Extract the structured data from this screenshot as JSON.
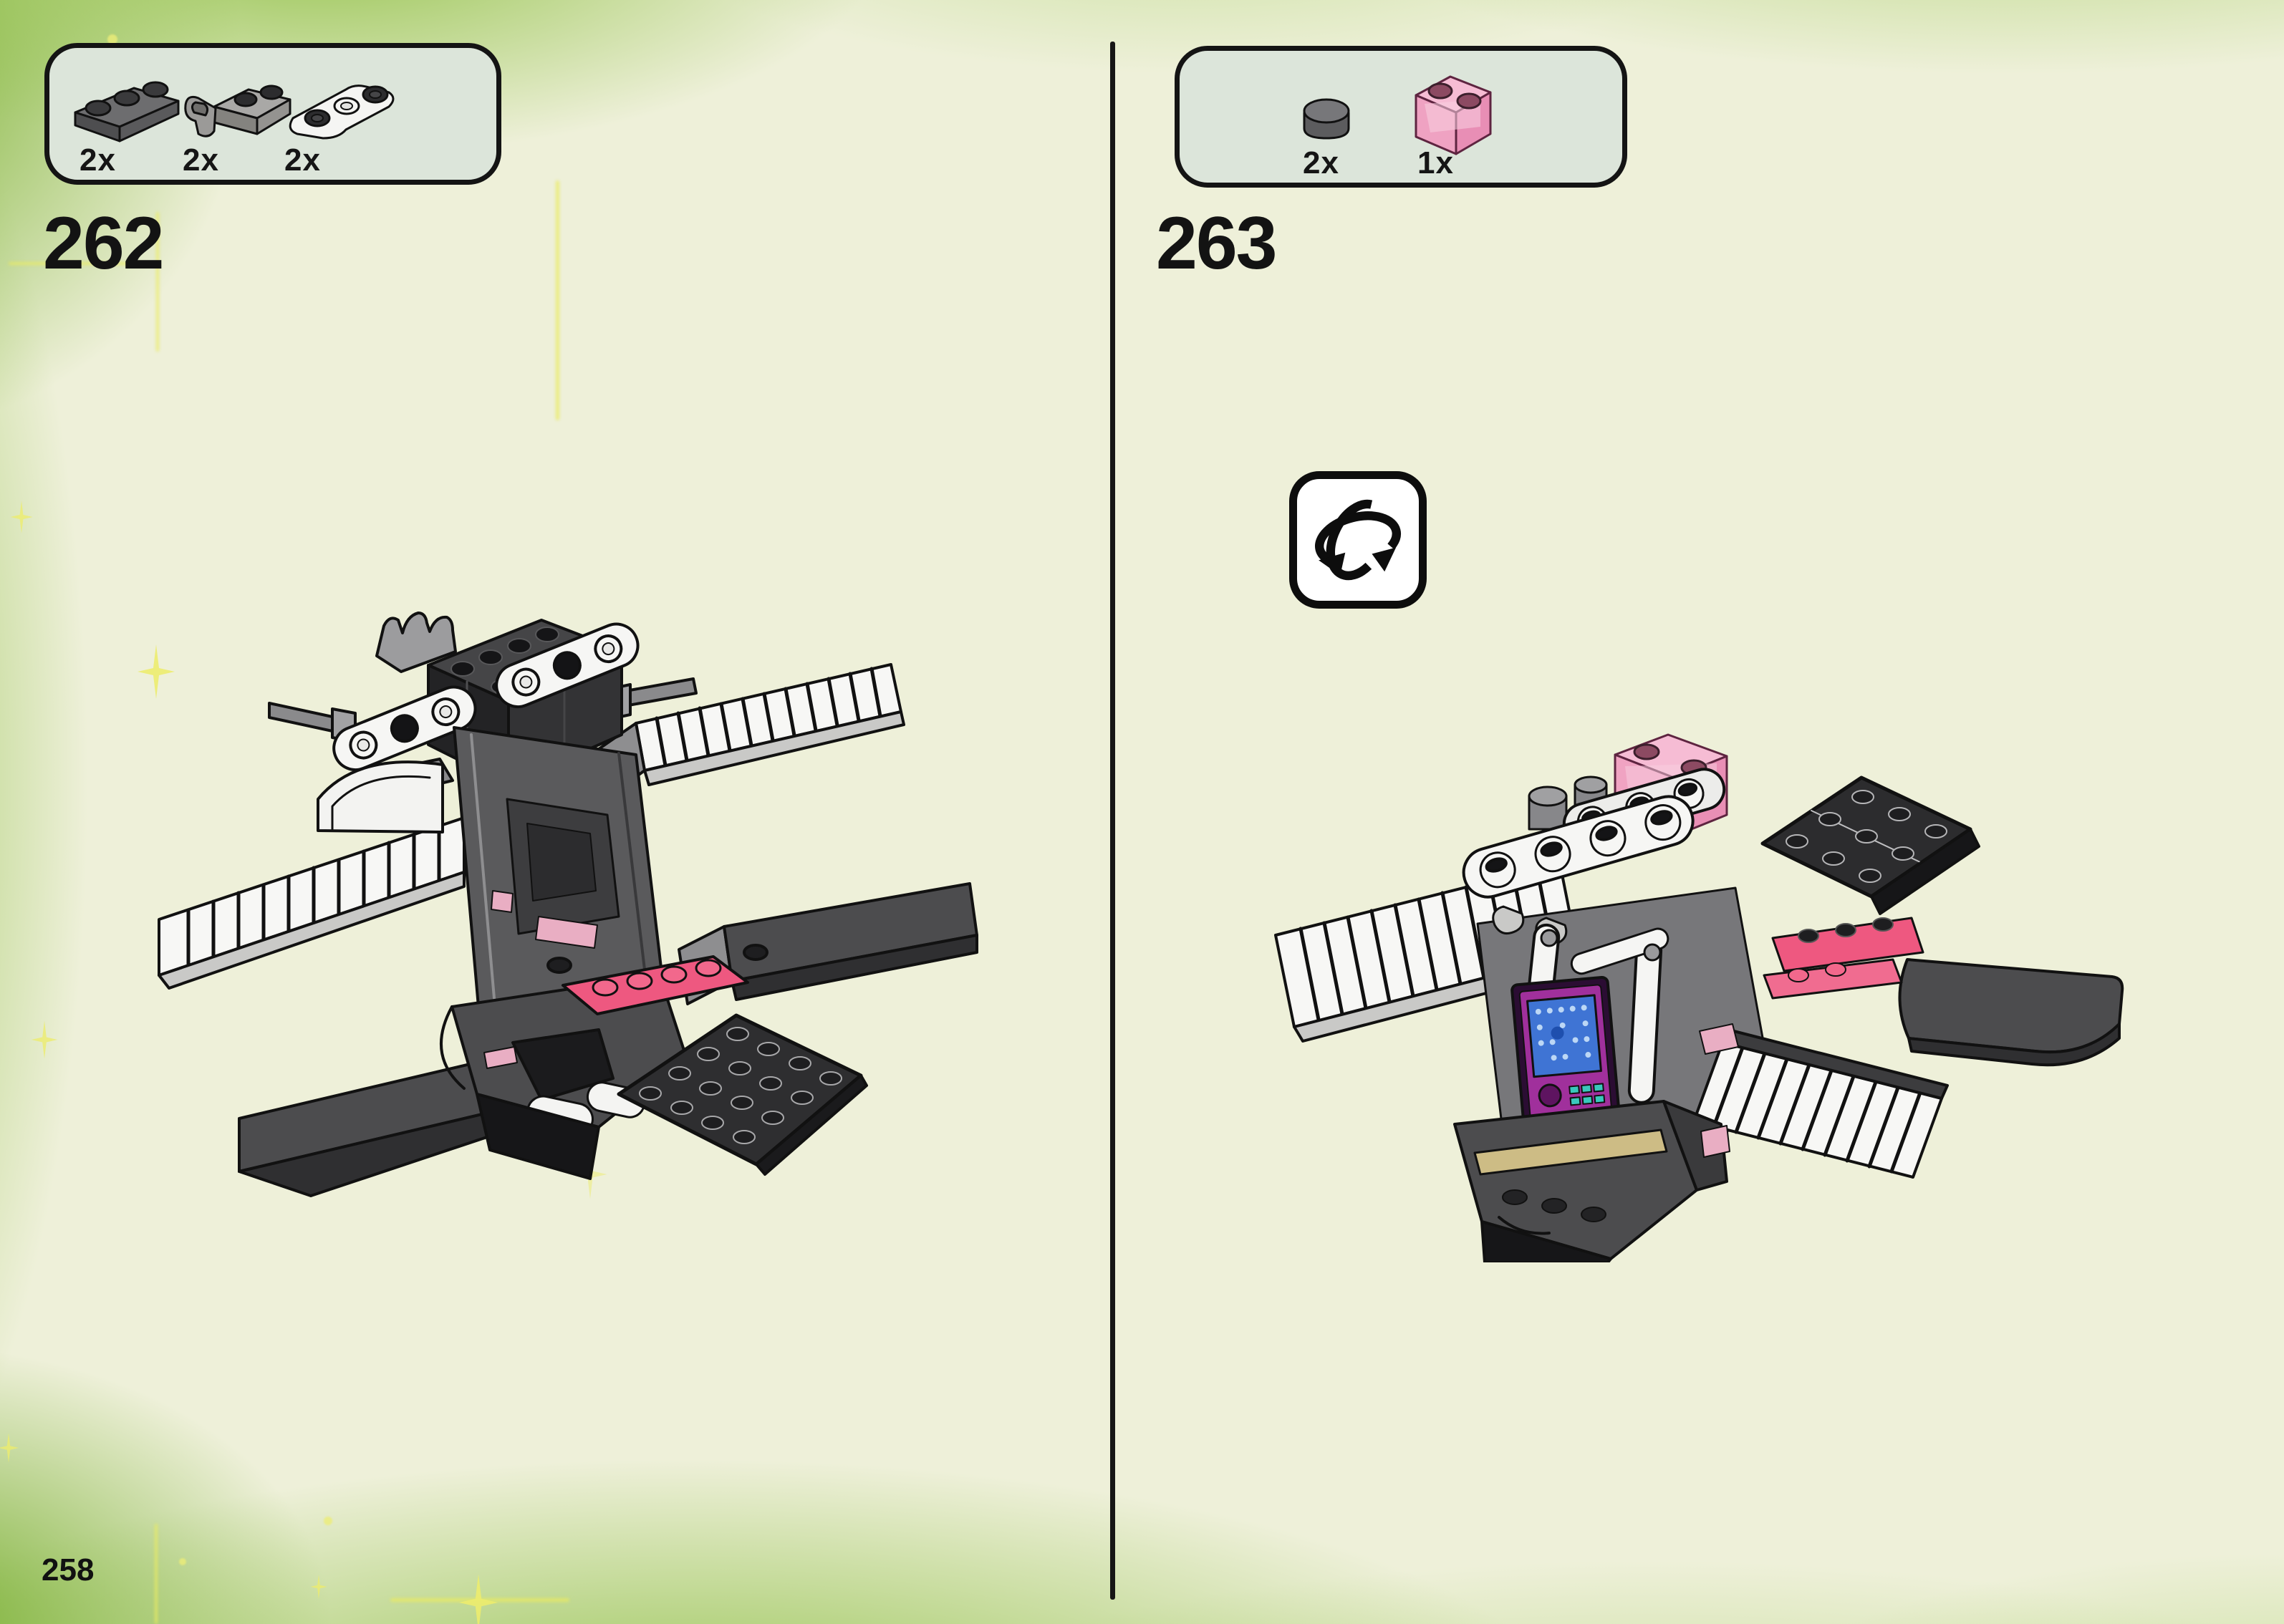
{
  "page": {
    "number": "258",
    "colors": {
      "background": "#eef0d9",
      "edge_green": "#84ba36",
      "sparkle_yellow": "#ebeb5f",
      "parts_box_fill": "#dce5da",
      "box_border": "#141414",
      "ink": "#131313"
    }
  },
  "steps": [
    {
      "number": "262",
      "parts_box": {
        "items": [
          {
            "qty": "2x",
            "part": "plate-1x3-dark-gray",
            "color": "#6d6d6f"
          },
          {
            "qty": "2x",
            "part": "plate-1x2-with-clip-gray",
            "color": "#a9a8a6"
          },
          {
            "qty": "2x",
            "part": "plate-1x3-rounded-white",
            "color": "#f5f5f3"
          }
        ]
      },
      "model": {
        "description": "dark-gray spacecraft assembly, three-quarter front view",
        "colors": {
          "dark_gray": "#4c4c4e",
          "medium_gray": "#8e8e90",
          "black": "#1e1e20",
          "white": "#f5f5f3",
          "dark_pink": "#ee5880",
          "trans_pink": "#e9aec3"
        }
      }
    },
    {
      "number": "263",
      "parts_box": {
        "items": [
          {
            "qty": "2x",
            "part": "round-tile-1x1-dark-gray",
            "color": "#6d6d6f"
          },
          {
            "qty": "1x",
            "part": "brick-1x2-trans-pink",
            "color": "#f09cc0"
          }
        ]
      },
      "rotate_icon": "rotate-model-icon",
      "model": {
        "description": "same spacecraft assembly rotated, rear three-quarter view",
        "colors": {
          "dark_gray": "#4c4c4e",
          "black": "#2c2c2e",
          "white": "#f5f5f3",
          "dark_pink": "#ee5880",
          "trans_pink": "#f0b4d0",
          "tan": "#cdbc85",
          "panel_purple": "#a0309c",
          "screen_blue": "#3f74d4",
          "button_teal": "#39c8bc"
        }
      }
    }
  ]
}
